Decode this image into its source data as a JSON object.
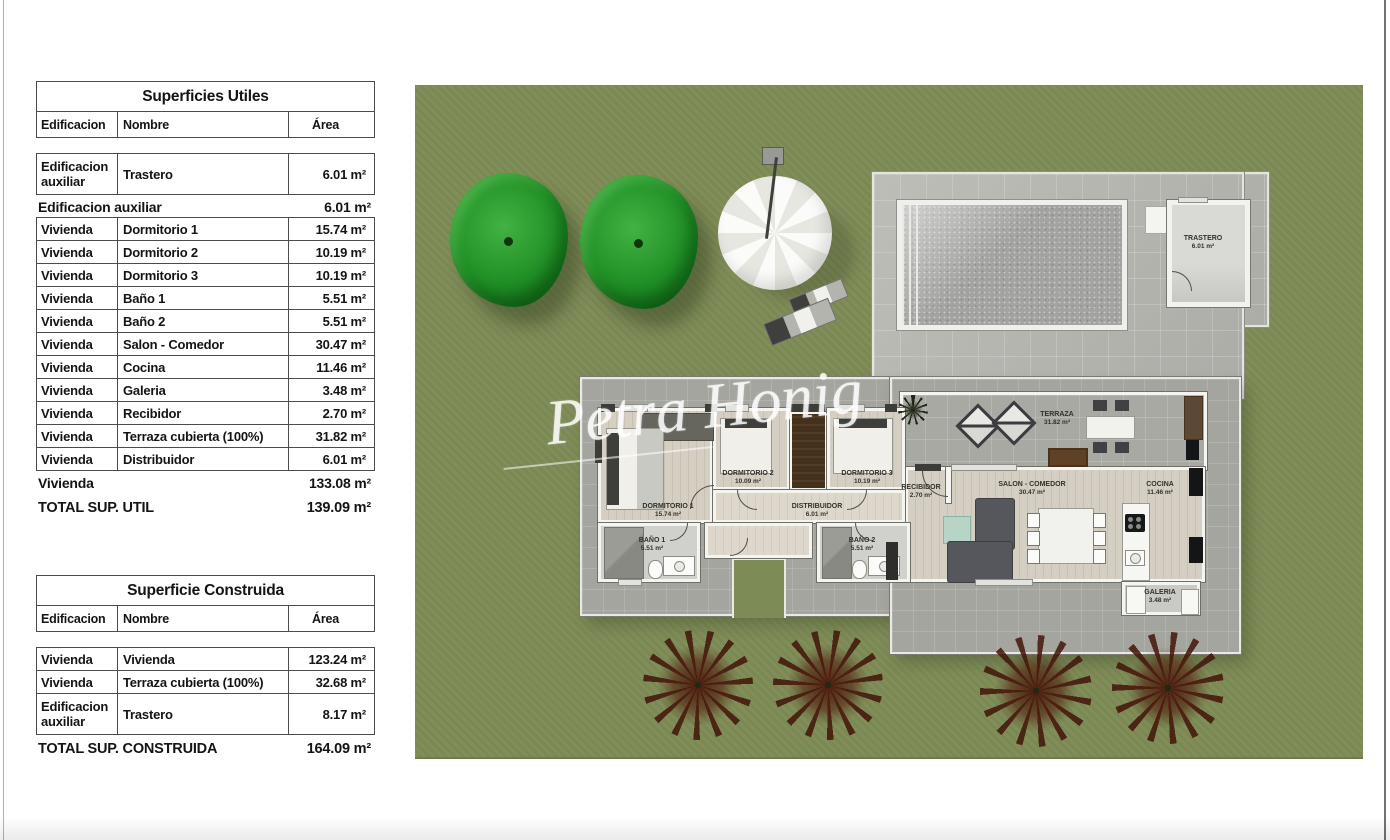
{
  "plan": {
    "watermark": "Petra Honig",
    "labels": {
      "dorm1": {
        "name": "DORMITORIO 1",
        "area": "15.74 m²"
      },
      "dorm2": {
        "name": "DORMITORIO 2",
        "area": "10.09 m²"
      },
      "dorm3": {
        "name": "DORMITORIO 3",
        "area": "10.19 m²"
      },
      "bano1": {
        "name": "BAÑO 1",
        "area": "5.51 m²"
      },
      "bano2": {
        "name": "BAÑO 2",
        "area": "5.51 m²"
      },
      "distribuidor": {
        "name": "DISTRIBUIDOR",
        "area": "6.01 m²"
      },
      "recibidor": {
        "name": "RECIBIDOR",
        "area": "2.70 m²"
      },
      "salon": {
        "name": "SALON - COMEDOR",
        "area": "30.47 m²"
      },
      "cocina": {
        "name": "COCINA",
        "area": "11.46 m²"
      },
      "galeria": {
        "name": "GALERIA",
        "area": "3.48 m²"
      },
      "terraza": {
        "name": "TERRAZA",
        "area": "31.82 m²"
      },
      "trastero": {
        "name": "TRASTERO",
        "area": "6.01 m²"
      }
    }
  },
  "tables": {
    "utiles": {
      "title": "Superficies Utiles",
      "columns": [
        "Edificacion",
        "Nombre",
        "Área"
      ],
      "rows": [
        {
          "cells": [
            "Edificacion auxiliar",
            "Trastero",
            "6.01 m²"
          ],
          "tall": true
        },
        {
          "subtotal": {
            "label": "Edificacion auxiliar",
            "area": "6.01 m²"
          }
        },
        {
          "cells": [
            "Vivienda",
            "Dormitorio 1",
            "15.74 m²"
          ]
        },
        {
          "cells": [
            "Vivienda",
            "Dormitorio 2",
            "10.19 m²"
          ]
        },
        {
          "cells": [
            "Vivienda",
            "Dormitorio 3",
            "10.19 m²"
          ]
        },
        {
          "cells": [
            "Vivienda",
            "Baño 1",
            "5.51 m²"
          ]
        },
        {
          "cells": [
            "Vivienda",
            "Baño 2",
            "5.51 m²"
          ]
        },
        {
          "cells": [
            "Vivienda",
            "Salon - Comedor",
            "30.47 m²"
          ]
        },
        {
          "cells": [
            "Vivienda",
            "Cocina",
            "11.46 m²"
          ]
        },
        {
          "cells": [
            "Vivienda",
            "Galeria",
            "3.48 m²"
          ]
        },
        {
          "cells": [
            "Vivienda",
            "Recibidor",
            "2.70 m²"
          ]
        },
        {
          "cells": [
            "Vivienda",
            "Terraza cubierta (100%)",
            "31.82 m²"
          ]
        },
        {
          "cells": [
            "Vivienda",
            "Distribuidor",
            "6.01 m²"
          ]
        },
        {
          "subtotal": {
            "label": "Vivienda",
            "area": "133.08 m²"
          }
        },
        {
          "total": {
            "label": "TOTAL SUP. UTIL",
            "area": "139.09 m²"
          }
        }
      ]
    },
    "construida": {
      "title": "Superficie Construida",
      "columns": [
        "Edificacion",
        "Nombre",
        "Área"
      ],
      "rows": [
        {
          "cells": [
            "Vivienda",
            "Vivienda",
            "123.24 m²"
          ]
        },
        {
          "cells": [
            "Vivienda",
            "Terraza cubierta (100%)",
            "32.68 m²"
          ]
        },
        {
          "cells": [
            "Edificacion auxiliar",
            "Trastero",
            "8.17 m²"
          ],
          "tall": true
        },
        {
          "total": {
            "label": "TOTAL SUP. CONSTRUIDA",
            "area": "164.09 m²"
          }
        }
      ]
    }
  },
  "colors": {
    "lawn": "#7d8b56",
    "patio": "#b6b6b0",
    "pool_water": "#a3a3a1",
    "tree_green": "#2aa32e",
    "bush_maroon": "#5a2114",
    "wall_white": "#f4f4f1",
    "wood_floor": "#d5cec2",
    "wardrobe_brown": "#4a3420",
    "table_text": "#141414"
  }
}
